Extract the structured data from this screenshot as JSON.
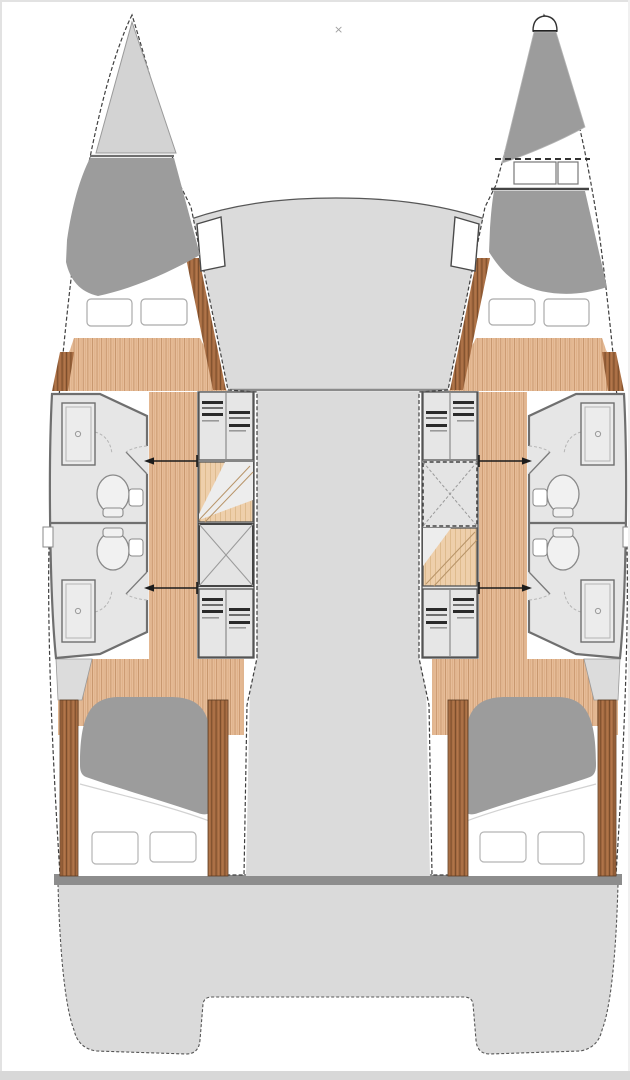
{
  "diagram": {
    "type": "catamaran-4-cabin-deck-plan",
    "marker_glyph": "×"
  },
  "palette": {
    "background": "#ffffff",
    "frame": "#e2e2e2",
    "bottom_bar": "#d8d8d8",
    "outline": "#3f3f3f",
    "deck": "#dbdbdb",
    "platform": "#dadada",
    "crossbeam": "#8d8d8d",
    "locker": "#d3d3d3",
    "shaded_area": "#9c9c9c",
    "mattress": "#9c9c9c",
    "bathroom_floor": "#e6e6e6",
    "wall": "#6f6f6f",
    "wood": "#e7bd99",
    "wood_line": "#c6946b",
    "wood_line2": "#dcab83",
    "steps_wood": "#eecfab",
    "trim": "#a46a41",
    "trim_line": "#7c4e2c",
    "white": "#ffffff",
    "fixture": "#f1f1f1",
    "fixture_stroke": "#8a8a8a",
    "shelf_dark": "#2a2a2a",
    "shelf_mid": "#6f6f6f",
    "marker": "#9f9f9f"
  },
  "regions": {
    "hulls": [
      "port-hull",
      "starboard-hull"
    ],
    "center": [
      "foredeck",
      "bridgedeck",
      "aft-crossbeam",
      "stern-platform"
    ],
    "cabins": [
      "forward-cabin",
      "aft-cabin"
    ],
    "facilities": [
      "head-with-shower",
      "toilet",
      "shower-stall",
      "wardrobe-shelves",
      "companionway-steps",
      "storage-hatch",
      "forepeak-berth"
    ]
  }
}
